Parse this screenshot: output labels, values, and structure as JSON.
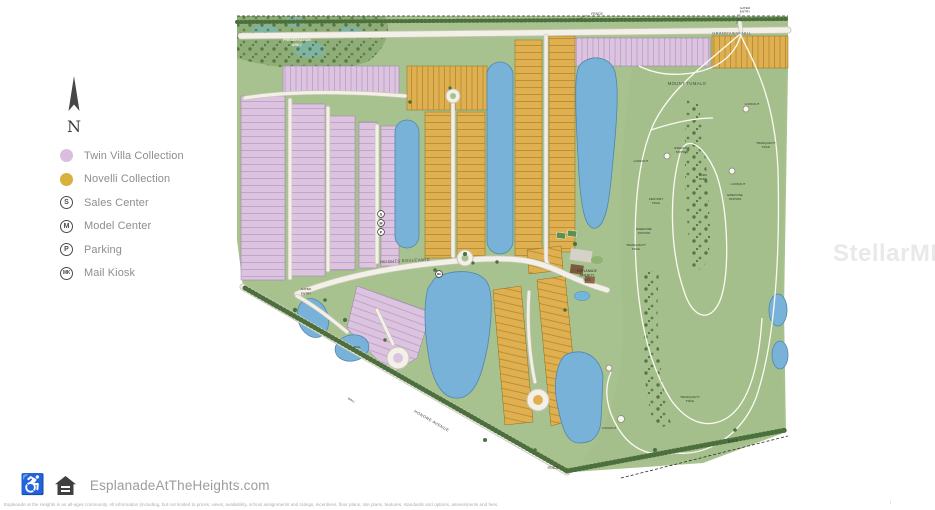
{
  "colors": {
    "twin_villa": "#d9bedd",
    "novelli": "#d6b13e",
    "water": "#79b2d8",
    "land": "#a8c28f",
    "road": "#f3f0e7"
  },
  "compass": {
    "north_label": "N"
  },
  "legend": {
    "items": [
      {
        "label": "Twin Villa Collection"
      },
      {
        "label": "Novelli Collection"
      },
      {
        "symbol": "S",
        "label": "Sales Center"
      },
      {
        "symbol": "M",
        "label": "Model Center"
      },
      {
        "symbol": "P",
        "label": "Parking"
      },
      {
        "symbol": "MK",
        "label": "Mail Kiosk"
      }
    ]
  },
  "map": {
    "streets": {
      "grandview_hill": "GRANDVIEW HILL",
      "mount_tumalo": "MOUNT TUMALO",
      "heights_boulevard": "HEIGHTS BOULEVARD",
      "honore_avenue": "HONORE AVENUE"
    },
    "areas": {
      "wetland_1": "WETLAND",
      "wetland_2": "PRESERVATION",
      "wetland_3": "AREA",
      "amenity_1": "ESPLANADE",
      "amenity_2": "AMENITY",
      "amenity_3": "SITE",
      "park_1": "BARK",
      "park_2": "PARK"
    },
    "features": {
      "fence": "FENCE",
      "gated_1": "GATED",
      "gated_2": "ENTRY",
      "wall": "WALL",
      "lookout": "LOOKOUT",
      "tranquility_1": "TRANQUILITY",
      "tranquility_2": "TRAIL",
      "exercise_1": "EXERCISE",
      "exercise_2": "STATION",
      "century_1": "CENTURY",
      "century_2": "TRAIL"
    },
    "markers": {
      "sales": "S",
      "model": "M",
      "parking": "P",
      "mail_kiosk": "MK"
    }
  },
  "footer": {
    "website": "EsplanadeAtTheHeights.com",
    "disclaimer": "Esplanade at the Heights is an all-ages community. All information (including, but not limited to prices, views, availability, school assignments and ratings, incentives, floor plans, site plans, features, standards and options, assessments and fees."
  },
  "watermark": {
    "text": "StellarMLS"
  },
  "corner_mark": {
    "text": "i"
  }
}
